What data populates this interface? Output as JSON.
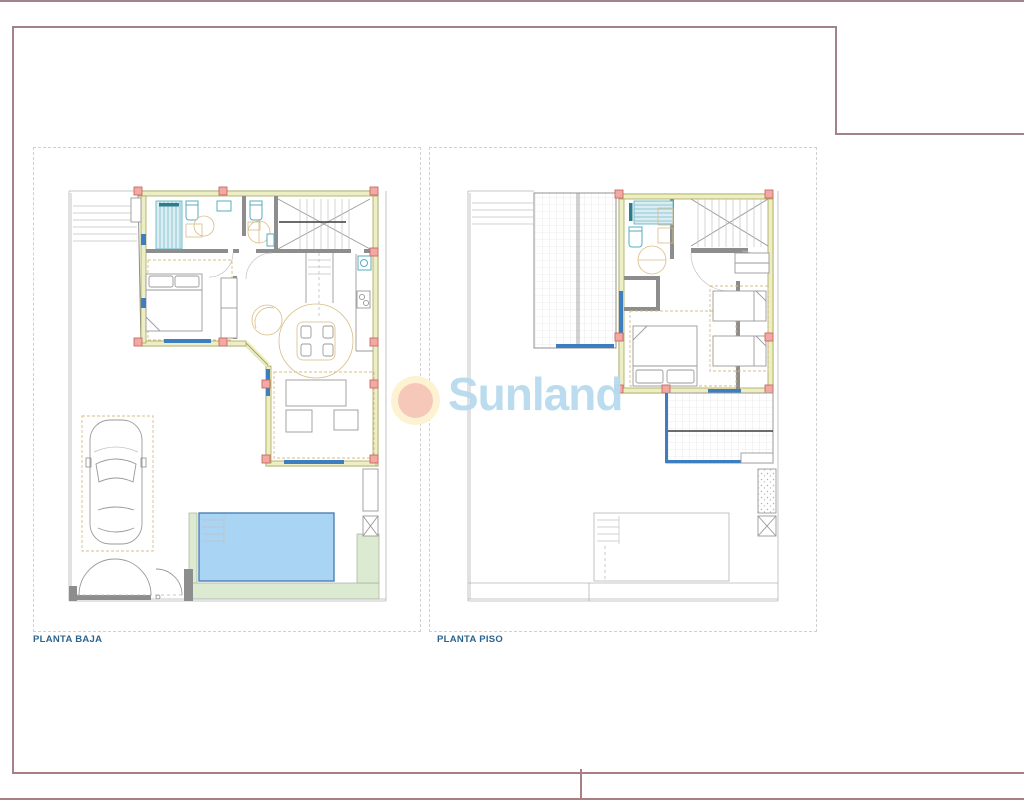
{
  "sheet": {
    "width": 1024,
    "height": 800
  },
  "panels": [
    {
      "id": "planta-baja",
      "label": "PLANTA BAJA"
    },
    {
      "id": "planta-piso",
      "label": "PLANTA PISO"
    }
  ],
  "watermark": {
    "text": "Sunland"
  },
  "colors": {
    "border_top": "#a2838c",
    "border_bottom": "#aa7f83",
    "panel_dash": "#d0d0d0",
    "label_blue": "#2a648f",
    "wall_fill": "#eeeec4",
    "wall_stroke": "#a6a65a",
    "pillar_fill": "#f2a9a4",
    "pillar_stroke": "#c96a62",
    "window_blue": "#3d7ec0",
    "fixture_teal": "#5aacbf",
    "shower_fill": "#d9edf3",
    "shower_stripe": "#8fc6d6",
    "furniture_tan": "#d9bd84",
    "pool_fill": "#a9d4f4",
    "pool_stroke": "#4e7fb5",
    "grass_green": "#dcead2",
    "grass_stroke": "#a4b399",
    "gray_wall": "#8d8d8d",
    "line_gray": "#9a9a9a",
    "logo_text": "#b8dbef",
    "logo_outer": "#fdf3d2",
    "logo_inner": "#f6c8ba"
  }
}
